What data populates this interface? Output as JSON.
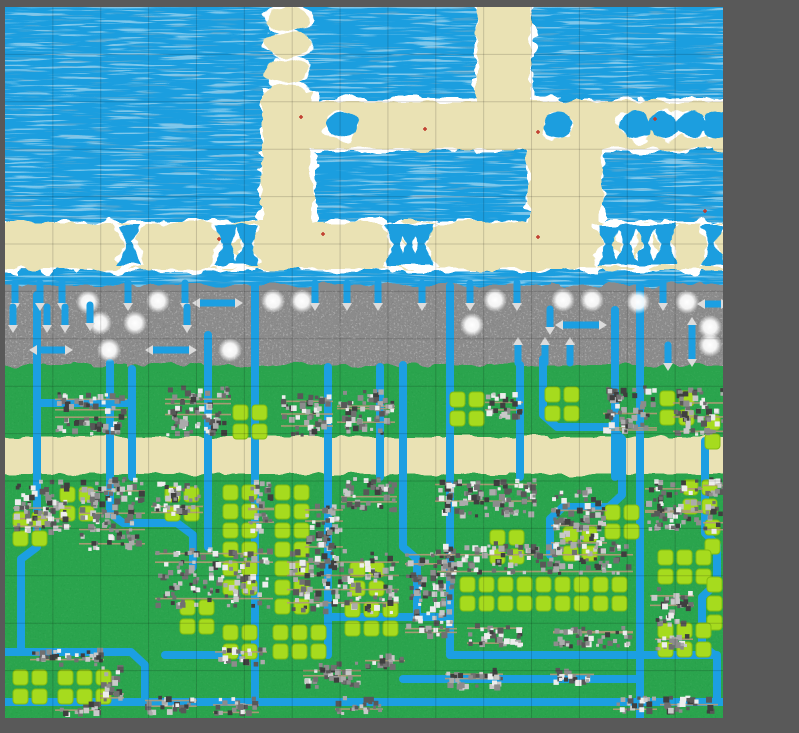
{
  "app": {
    "kind": "tile-world-map-viewport"
  },
  "palette": {
    "bg": "#595959",
    "water": "#1B9EDF",
    "waterWaveLight": "#cfe9f6",
    "waterWaveDark": "#8fb0c2",
    "sand": "#EAE2B4",
    "foam": "#FFFFFF",
    "rock": "#8B8B8B",
    "rockLight": "#FFFFFF",
    "rockDark": "#5A5A5A",
    "grass": "#2CA44D",
    "grassDark": "#157C36",
    "grassLight": "#6CC581",
    "field": "#A6DB1E",
    "fieldEdge": "#84BC10",
    "river": "#1C9FE2",
    "villageColors": [
      "#3f3f3f",
      "#585858",
      "#707070",
      "#8c8c8c",
      "#ababab",
      "#c9c9c9",
      "#ededed"
    ],
    "villageRoad": "#b49a78",
    "arrow": "#DCDCDC",
    "redMark": "#C0392B",
    "grid": "rgba(0,0,0,0.16)"
  },
  "geometry": {
    "canvas": {
      "w": 799,
      "h": 733
    },
    "map": {
      "x": 5,
      "y": 7,
      "w": 718,
      "h": 711
    },
    "grid": {
      "cols": 15,
      "rows": 15
    }
  },
  "terrain": {
    "bands": {
      "coast": {
        "x": -12,
        "y": 216,
        "w": 742,
        "h": 46
      },
      "mountain": {
        "x": -12,
        "y": 278,
        "w": 742,
        "h": 88
      },
      "grass": {
        "x": -12,
        "y": 358,
        "w": 742,
        "h": 366
      },
      "road": {
        "x": -12,
        "y": 430,
        "w": 742,
        "h": 37
      }
    },
    "sandShapes": {
      "lensChain": {
        "cx": 283,
        "startY": 12,
        "count": 4,
        "dy": 26,
        "rx": 22,
        "ry": 12
      },
      "rects": [
        {
          "x": 257,
          "y": 84,
          "w": 50,
          "h": 142
        },
        {
          "x": 472,
          "y": -12,
          "w": 54,
          "h": 152
        },
        {
          "x": 278,
          "y": 94,
          "w": 450,
          "h": 48
        },
        {
          "x": 524,
          "y": 100,
          "w": 72,
          "h": 126
        }
      ]
    },
    "waterEyes": {
      "cy": 118,
      "rx": 15,
      "ry": 13,
      "cx": [
        338,
        553,
        630,
        658,
        686,
        712
      ]
    },
    "coastBowties": {
      "topY": 218,
      "midY": 237,
      "botY": 258,
      "halfW": 11,
      "cx": [
        125,
        222,
        242,
        391,
        404,
        417,
        603,
        622,
        641,
        660,
        708
      ]
    }
  },
  "rivers": [
    [
      [
        32,
        288
      ],
      [
        32,
        540
      ],
      [
        16,
        552
      ],
      [
        16,
        645
      ]
    ],
    [
      [
        105,
        356
      ],
      [
        105,
        506
      ],
      [
        118,
        516
      ],
      [
        172,
        516
      ],
      [
        188,
        528
      ],
      [
        188,
        560
      ]
    ],
    [
      [
        127,
        362
      ],
      [
        127,
        470
      ]
    ],
    [
      [
        32,
        396
      ],
      [
        127,
        396
      ]
    ],
    [
      [
        203,
        328
      ],
      [
        203,
        540
      ]
    ],
    [
      [
        250,
        279
      ],
      [
        250,
        695
      ]
    ],
    [
      [
        323,
        360
      ],
      [
        323,
        648
      ]
    ],
    [
      [
        375,
        360
      ],
      [
        375,
        470
      ]
    ],
    [
      [
        398,
        358
      ],
      [
        398,
        540
      ],
      [
        412,
        552
      ],
      [
        412,
        610
      ]
    ],
    [
      [
        445,
        279
      ],
      [
        445,
        648
      ]
    ],
    [
      [
        515,
        358
      ],
      [
        515,
        470
      ]
    ],
    [
      [
        538,
        352
      ],
      [
        538,
        408
      ],
      [
        552,
        420
      ],
      [
        605,
        420
      ],
      [
        617,
        432
      ],
      [
        617,
        488
      ],
      [
        604,
        500
      ],
      [
        558,
        500
      ],
      [
        545,
        512
      ],
      [
        545,
        548
      ]
    ],
    [
      [
        610,
        303
      ],
      [
        610,
        470
      ]
    ],
    [
      [
        635,
        279
      ],
      [
        635,
        711
      ]
    ],
    [
      [
        700,
        434
      ],
      [
        700,
        526
      ],
      [
        712,
        538
      ],
      [
        712,
        576
      ],
      [
        697,
        590
      ],
      [
        697,
        638
      ],
      [
        712,
        650
      ],
      [
        712,
        695
      ]
    ],
    [
      [
        0,
        645
      ],
      [
        126,
        645
      ],
      [
        140,
        658
      ],
      [
        140,
        695
      ]
    ],
    [
      [
        160,
        648
      ],
      [
        250,
        648
      ]
    ],
    [
      [
        0,
        695
      ],
      [
        718,
        695
      ]
    ],
    [
      [
        323,
        610
      ],
      [
        445,
        610
      ]
    ],
    [
      [
        445,
        648
      ],
      [
        712,
        648
      ]
    ],
    [
      [
        398,
        672
      ],
      [
        635,
        672
      ]
    ]
  ],
  "mountainDecals": {
    "snow": [
      [
        83,
        295
      ],
      [
        153,
        294
      ],
      [
        268,
        294
      ],
      [
        297,
        294
      ],
      [
        490,
        293
      ],
      [
        558,
        293
      ],
      [
        587,
        293
      ],
      [
        633,
        295
      ],
      [
        682,
        295
      ],
      [
        95,
        316
      ],
      [
        130,
        316
      ],
      [
        467,
        318
      ],
      [
        705,
        320
      ],
      [
        104,
        343
      ],
      [
        225,
        343
      ],
      [
        705,
        338
      ]
    ],
    "topFalls": {
      "y0": 276,
      "y1": 296,
      "x": [
        10,
        35,
        57,
        123,
        180,
        310,
        342,
        373,
        417,
        465,
        512,
        658
      ]
    },
    "midFalls": [
      [
        8,
        300,
        318
      ],
      [
        42,
        300,
        318
      ],
      [
        60,
        300,
        318
      ],
      [
        85,
        298,
        316
      ],
      [
        182,
        300,
        318
      ],
      [
        545,
        302,
        320
      ]
    ],
    "upStubs": [
      [
        513,
        338,
        356
      ],
      [
        540,
        338,
        356
      ],
      [
        565,
        338,
        356
      ]
    ],
    "downStubs": [
      [
        663,
        338,
        356
      ]
    ],
    "doubleStubs": [
      [
        687,
        318,
        352
      ]
    ],
    "hArrows": [
      [
        195,
        230,
        296
      ],
      [
        32,
        60,
        343
      ],
      [
        148,
        184,
        343
      ],
      [
        558,
        594,
        318
      ],
      [
        700,
        716,
        297
      ]
    ]
  },
  "fields": {
    "square": 15,
    "pitch": 19,
    "clusters": [
      [
        228,
        398,
        2,
        2
      ],
      [
        445,
        385,
        2,
        2
      ],
      [
        540,
        380,
        2,
        2
      ],
      [
        655,
        384,
        2,
        2
      ],
      [
        700,
        408,
        2,
        2
      ],
      [
        8,
        505,
        2,
        2
      ],
      [
        55,
        480,
        2,
        2
      ],
      [
        160,
        480,
        2,
        2
      ],
      [
        218,
        478,
        2,
        6
      ],
      [
        270,
        478,
        2,
        7
      ],
      [
        485,
        523,
        2,
        2
      ],
      [
        558,
        520,
        2,
        2
      ],
      [
        678,
        473,
        2,
        2
      ],
      [
        600,
        498,
        2,
        2
      ],
      [
        700,
        513,
        2,
        2
      ],
      [
        455,
        570,
        9,
        2
      ],
      [
        653,
        543,
        3,
        2
      ],
      [
        702,
        570,
        2,
        3
      ],
      [
        653,
        616,
        3,
        2
      ],
      [
        345,
        555,
        2,
        2
      ],
      [
        340,
        595,
        3,
        2
      ],
      [
        175,
        593,
        2,
        2
      ],
      [
        218,
        618,
        2,
        2
      ],
      [
        268,
        618,
        3,
        2
      ],
      [
        8,
        663,
        2,
        2
      ],
      [
        53,
        663,
        3,
        2
      ]
    ]
  },
  "villages": [
    [
      50,
      385,
      72,
      44
    ],
    [
      160,
      378,
      66,
      52
    ],
    [
      276,
      386,
      52,
      44
    ],
    [
      332,
      382,
      58,
      46
    ],
    [
      480,
      384,
      38,
      30
    ],
    [
      598,
      377,
      54,
      50
    ],
    [
      668,
      380,
      52,
      50
    ],
    [
      8,
      472,
      58,
      56
    ],
    [
      74,
      470,
      66,
      74
    ],
    [
      146,
      474,
      52,
      36
    ],
    [
      243,
      470,
      26,
      58
    ],
    [
      300,
      496,
      38,
      48
    ],
    [
      336,
      470,
      56,
      36
    ],
    [
      430,
      470,
      102,
      42
    ],
    [
      546,
      480,
      56,
      62
    ],
    [
      640,
      472,
      58,
      52
    ],
    [
      698,
      470,
      22,
      58
    ],
    [
      150,
      540,
      118,
      62
    ],
    [
      282,
      542,
      112,
      66
    ],
    [
      400,
      542,
      52,
      92
    ],
    [
      432,
      534,
      196,
      34
    ],
    [
      462,
      616,
      56,
      26
    ],
    [
      548,
      618,
      80,
      24
    ],
    [
      645,
      580,
      44,
      40
    ],
    [
      25,
      640,
      74,
      20
    ],
    [
      95,
      658,
      24,
      40
    ],
    [
      140,
      688,
      52,
      22
    ],
    [
      50,
      694,
      46,
      16
    ],
    [
      210,
      640,
      52,
      20
    ],
    [
      208,
      688,
      46,
      22
    ],
    [
      298,
      654,
      58,
      28
    ],
    [
      440,
      660,
      58,
      24
    ],
    [
      545,
      660,
      44,
      20
    ],
    [
      608,
      688,
      44,
      20
    ],
    [
      650,
      624,
      38,
      20
    ],
    [
      655,
      688,
      58,
      20
    ],
    [
      330,
      688,
      48,
      20
    ],
    [
      360,
      645,
      40,
      18
    ]
  ],
  "redMarks": [
    [
      296,
      110
    ],
    [
      533,
      125
    ],
    [
      318,
      227
    ],
    [
      533,
      230
    ],
    [
      650,
      112
    ],
    [
      420,
      122
    ],
    [
      214,
      232
    ],
    [
      700,
      204
    ]
  ]
}
